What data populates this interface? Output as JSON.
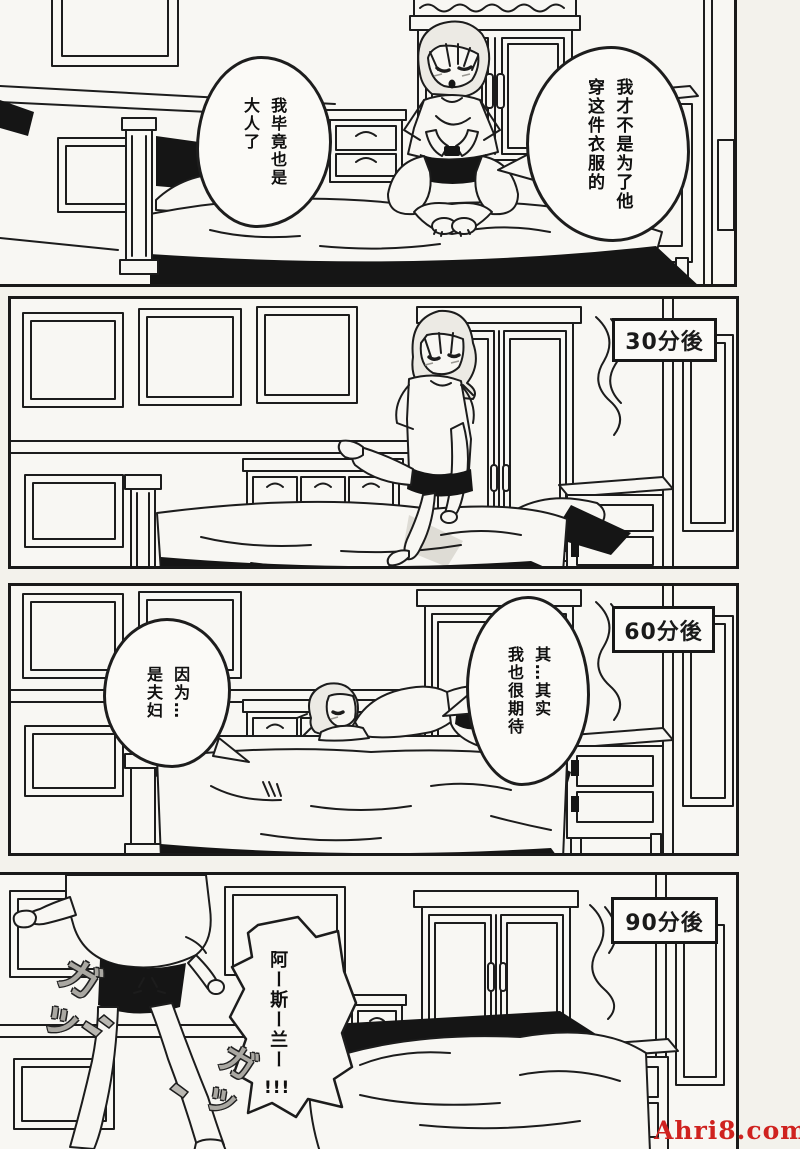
{
  "watermark": "Ahri8.com",
  "panel1": {
    "bubble_left": {
      "col1": "我毕竟也是",
      "col2": "大人了"
    },
    "bubble_right": {
      "col1": "我才不是为了他",
      "col2": "穿这件衣服的"
    }
  },
  "panel2": {
    "time_label": "30分後"
  },
  "panel3": {
    "time_label": "60分後",
    "bubble_left": {
      "col1": "因为…",
      "col2": "是夫妇"
    },
    "bubble_right": {
      "col1": "其…其实",
      "col2": "我也很期待"
    }
  },
  "panel4": {
    "time_label": "90分後",
    "shout": {
      "body": "阿ー斯ー兰ー",
      "suffix": "!!!"
    },
    "sfx_1": "ガッ",
    "sfx_2": "ガッ"
  }
}
